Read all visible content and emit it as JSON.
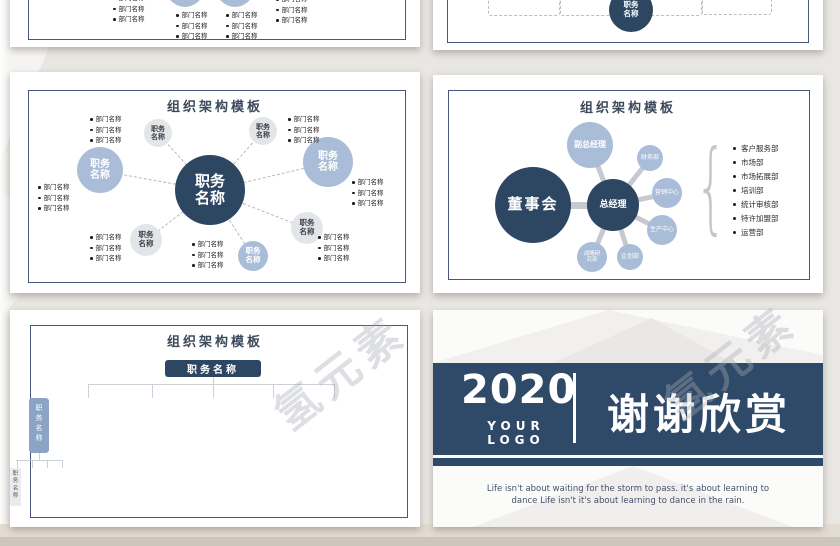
{
  "watermark": "氢元素",
  "common": {
    "title": "组织架构模板",
    "job": "职务名称",
    "dept": "部门名称"
  },
  "board": {
    "title": "组织架构模板",
    "chairman": "董事会",
    "gm": "总经理",
    "units": [
      "副总经理",
      "财务部",
      "营销中心",
      "生产中心",
      "企划部",
      "战略研究部"
    ],
    "departments": [
      "客户服务部",
      "市场部",
      "市场拓展部",
      "培训部",
      "统计审核部",
      "特许加盟部",
      "运营部"
    ]
  },
  "tree": {
    "title": "组织架构模板",
    "root": "职务名称",
    "branch": "职务名称",
    "leaf": "职务名称"
  },
  "thanks": {
    "year": "2020",
    "logo": "YOUR LOGO",
    "message": "谢谢欣赏",
    "quote1": "Life isn't about waiting for the storm to pass. it's about learning to",
    "quote2": "dance Life isn't it's about learning to dance in the rain."
  },
  "colors": {
    "navy": "#2d4763",
    "banner_navy": "#2e4a68",
    "light_blue": "#a9bdd8",
    "bar_blue": "#8ba3c5",
    "circle_gray": "#e4e5e9",
    "page_bg": "#e9e7e3"
  }
}
